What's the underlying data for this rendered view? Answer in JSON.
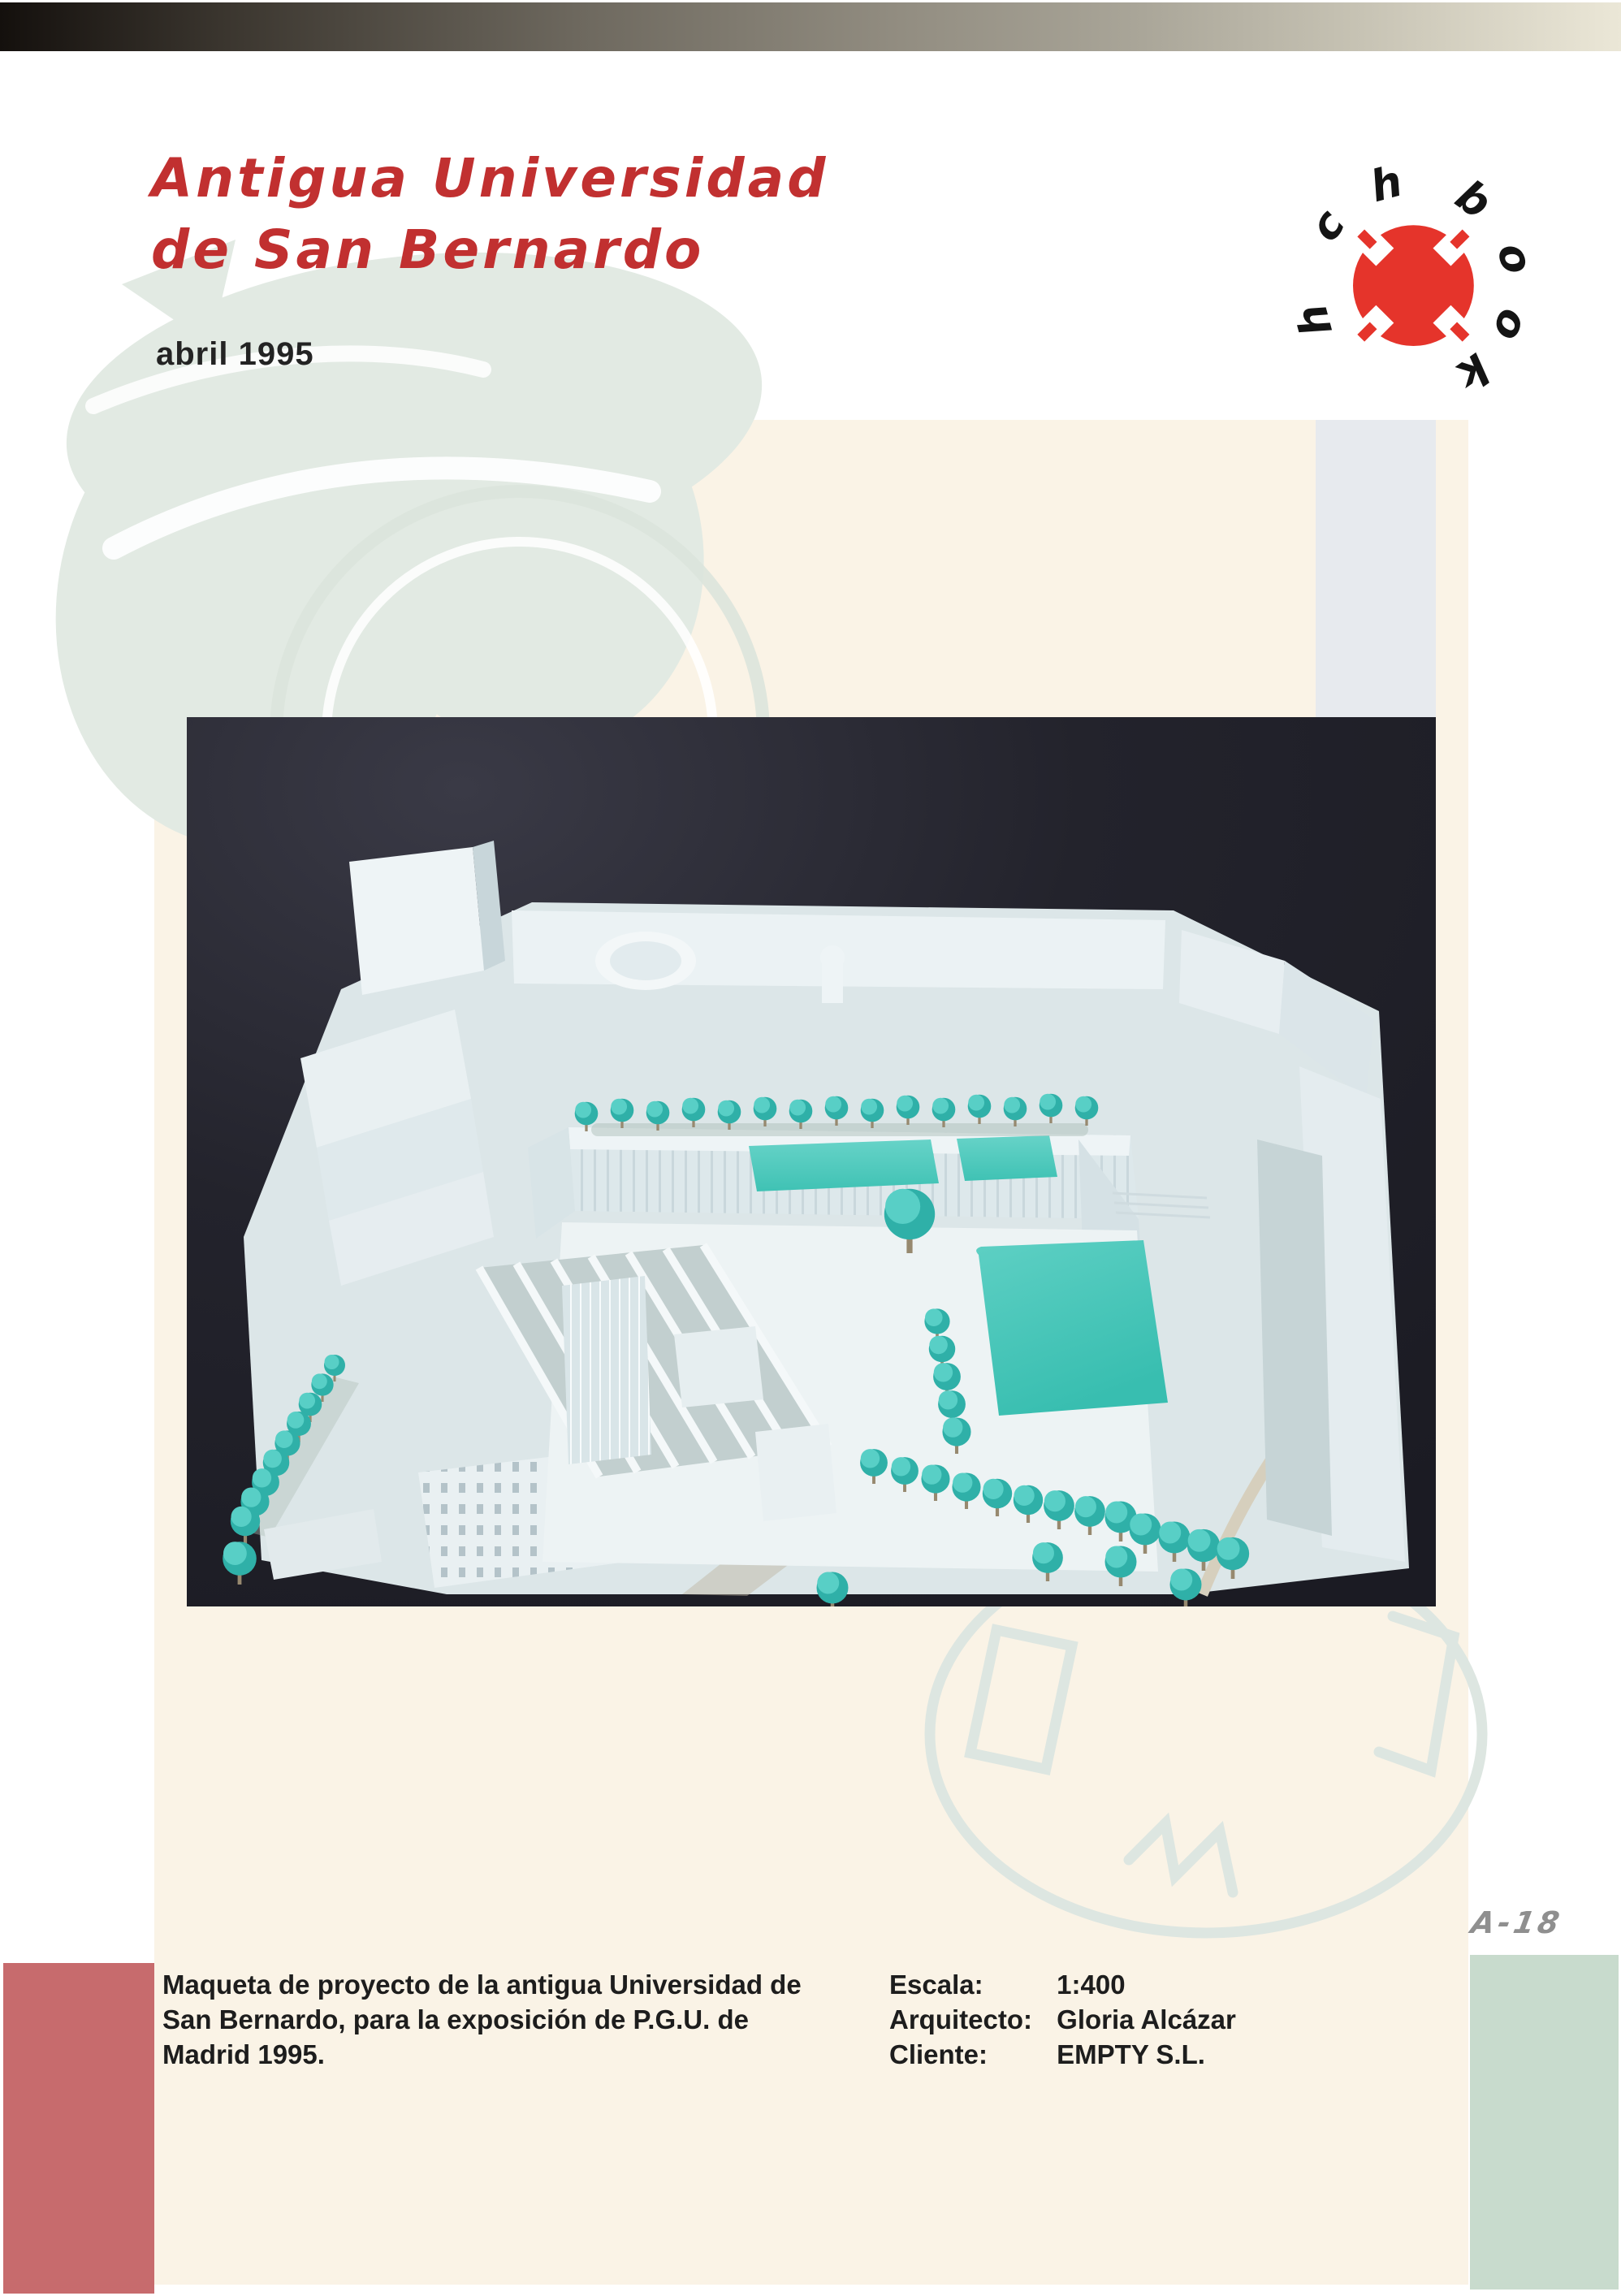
{
  "header": {
    "title_line1": "Antigua Universidad",
    "title_line2": "de San Bernardo",
    "date": "abril 1995"
  },
  "logo": {
    "letters": [
      "h",
      "c",
      "h",
      "b",
      "o",
      "o",
      "k"
    ],
    "circle_color": "#e5342b"
  },
  "photo": {
    "description": "Architectural scale model of the old Universidad de San Bernardo: white buildings around a courtyard with teal model trees and two turquoise pools, photographed on a black background"
  },
  "footer": {
    "page_number": "A-18",
    "caption_lines": [
      "Maqueta de proyecto de la antigua Universidad de",
      "San Bernardo, para la exposición de P.G.U. de",
      "Madrid 1995."
    ],
    "details": [
      {
        "label": "Escala:",
        "value": "1:400"
      },
      {
        "label": "Arquitecto:",
        "value": "Gloria Alcázar"
      },
      {
        "label": "Cliente:",
        "value": "EMPTY S.L."
      }
    ]
  },
  "colors": {
    "title_red": "#c13030",
    "logo_red": "#e5342b",
    "accent_salmon": "#c76b6d",
    "accent_mint": "#c8dbcd",
    "accent_bluegray": "#e7eaee",
    "cream_background": "#faf3e6",
    "decor_green": "#e2eae3",
    "photo_background": "#23232c",
    "model_teal": "#45c4b8",
    "page_number_gray": "#8f8f8f"
  }
}
